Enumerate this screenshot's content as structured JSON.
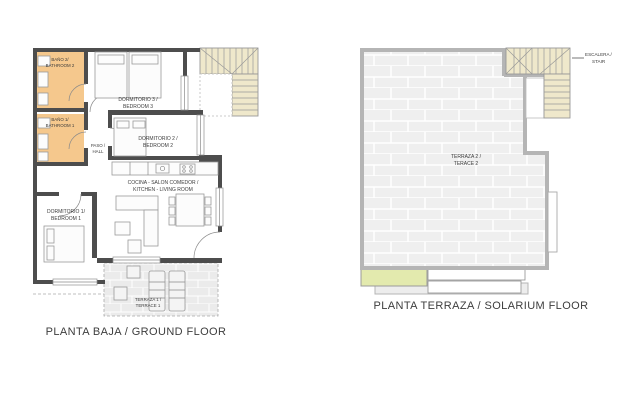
{
  "page": {
    "background": "#ffffff"
  },
  "colors": {
    "wall_dark": "#4d4d4d",
    "wall_light": "#b5b5b5",
    "bathroom_fill": "#f5c88d",
    "stair_fill": "#efe8cb",
    "tile_fill": "#efefef",
    "planter_fill": "#e3eaae"
  },
  "plans": [
    {
      "id": "ground-floor",
      "caption": "PLANTA BAJA / GROUND FLOOR",
      "rooms": [
        {
          "name": "bathroom-2",
          "line1": "BAÑO 2/",
          "line2": "BATHROOM 2"
        },
        {
          "name": "bathroom-1",
          "line1": "BAÑO 1/",
          "line2": "BATHROOM 1"
        },
        {
          "name": "bedroom-3",
          "line1": "DORMITORIO 3 /",
          "line2": "BEDROOM 3"
        },
        {
          "name": "hall",
          "line1": "PASO /",
          "line2": "HALL"
        },
        {
          "name": "bedroom-2",
          "line1": "DORMITORIO 2 /",
          "line2": "BEDROOM 2"
        },
        {
          "name": "kitchen-living",
          "line1": "COCINA - SALON COMEDOR /",
          "line2": "KITCHEN - LIVING ROOM"
        },
        {
          "name": "bedroom-1",
          "line1": "DORMITORIO 1/",
          "line2": "BEDROOM 1"
        },
        {
          "name": "terrace-1",
          "line1": "TERRAZA 1 /",
          "line2": "TERRACE 1"
        }
      ]
    },
    {
      "id": "solarium-floor",
      "caption": "PLANTA TERRAZA / SOLARIUM FLOOR",
      "rooms": [
        {
          "name": "terrace-2",
          "line1": "TERRAZA 2 /",
          "line2": "TERACE 2"
        },
        {
          "name": "stair",
          "line1": "ESCALERA /",
          "line2": "STAIR"
        }
      ]
    }
  ]
}
